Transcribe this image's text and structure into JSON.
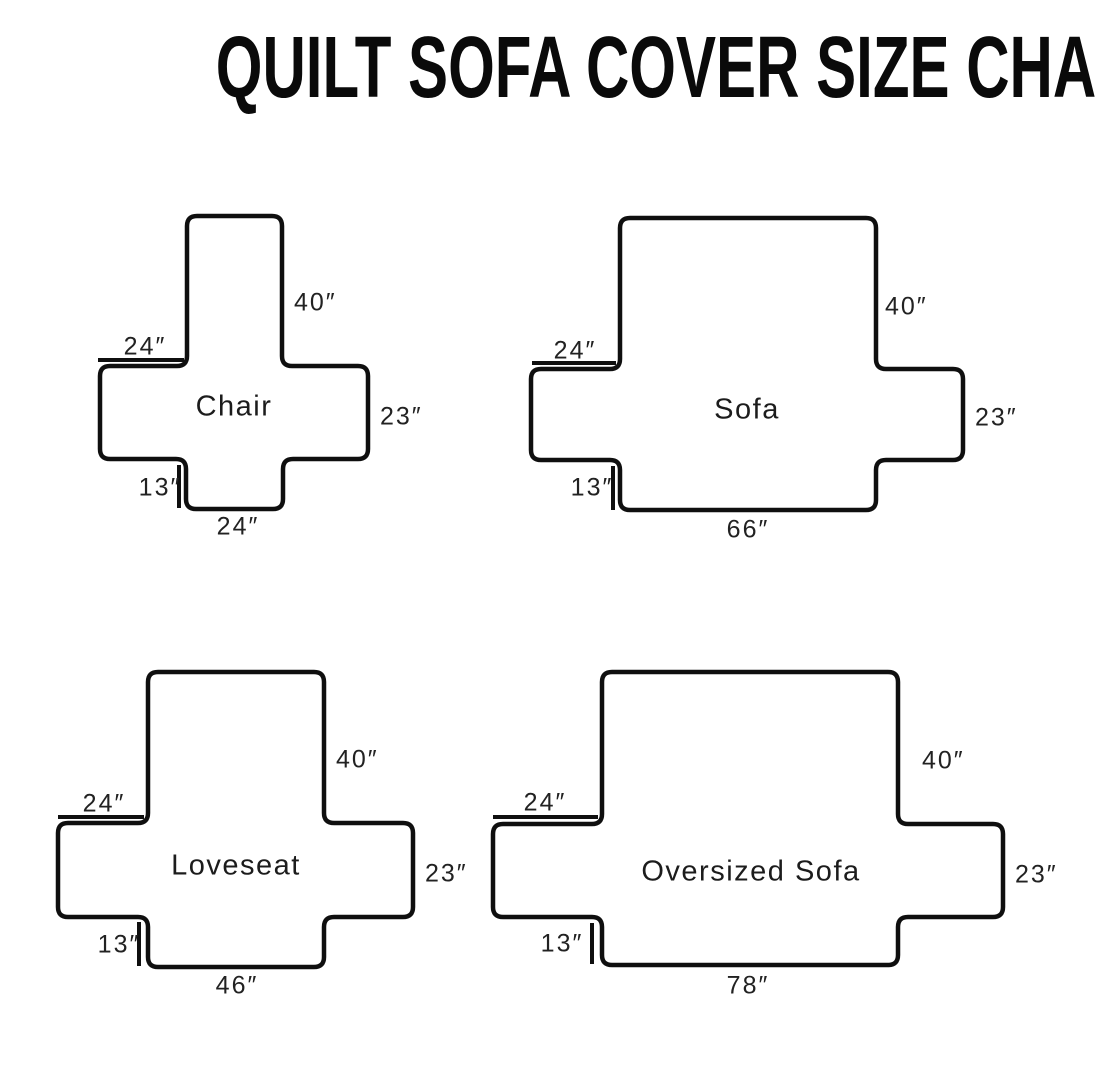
{
  "title": "QUILT SOFA COVER SIZE CHART",
  "colors": {
    "ink": "#0f0f0f",
    "background": "#ffffff"
  },
  "diagrams": [
    {
      "name": "Chair",
      "back_height": "40″",
      "arm_width": "24″",
      "side_height": "23″",
      "front_drop": "13″",
      "bottom_width": "24″"
    },
    {
      "name": "Sofa",
      "back_height": "40″",
      "arm_width": "24″",
      "side_height": "23″",
      "front_drop": "13″",
      "bottom_width": "66″"
    },
    {
      "name": "Loveseat",
      "back_height": "40″",
      "arm_width": "24″",
      "side_height": "23″",
      "front_drop": "13″",
      "bottom_width": "46″"
    },
    {
      "name": "Oversized Sofa",
      "back_height": "40″",
      "arm_width": "24″",
      "side_height": "23″",
      "front_drop": "13″",
      "bottom_width": "78″"
    }
  ]
}
